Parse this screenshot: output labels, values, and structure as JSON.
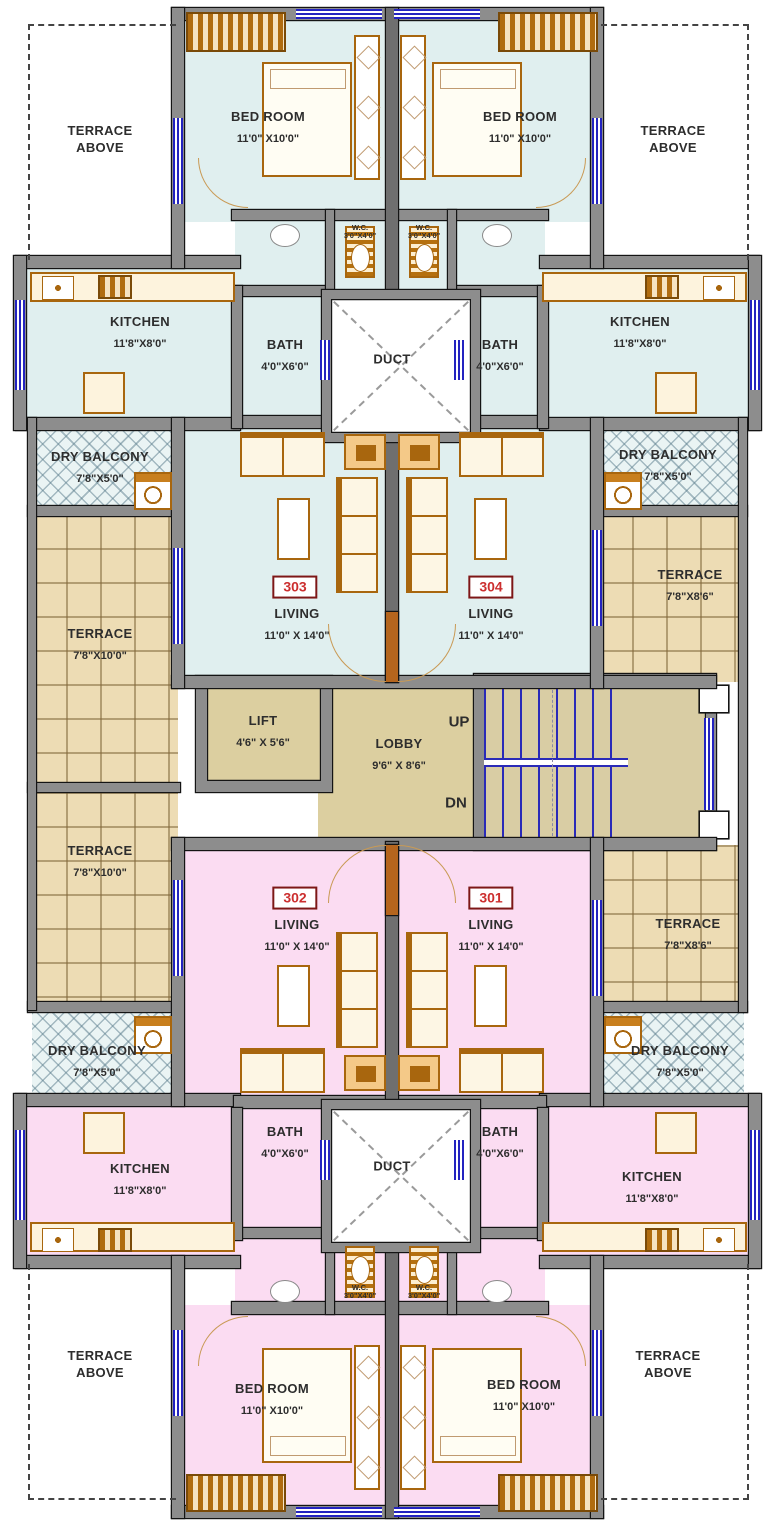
{
  "plan_title": "Typical residential floor plan",
  "colors": {
    "flat_upper_fill": "#e0efef",
    "flat_lower_fill": "#fbdcf2",
    "terrace_fill": "#eddcb4",
    "lobby_fill": "#dccfa0",
    "wall_gray": "#8d8d8d",
    "window_blue": "#2323c0",
    "furniture_orange": "#a8660e",
    "unit_number_red": "#cc2f2f"
  },
  "units": [
    {
      "number": "303",
      "room": "LIVING",
      "dim": "11'0\" X 14'0\""
    },
    {
      "number": "304",
      "room": "LIVING",
      "dim": "11'0\" X 14'0\""
    },
    {
      "number": "302",
      "room": "LIVING",
      "dim": "11'0\" X 14'0\""
    },
    {
      "number": "301",
      "room": "LIVING",
      "dim": "11'0\" X 14'0\""
    }
  ],
  "labels": {
    "terrace_above": {
      "l1": "TERRACE",
      "l2": "ABOVE"
    },
    "bedroom": {
      "name": "BED ROOM",
      "dim": "11'0\" X10'0\""
    },
    "kitchen": {
      "name": "KITCHEN",
      "dim": "11'8\"X8'0\""
    },
    "bath": {
      "name": "BATH",
      "dim": "4'0\"X6'0\""
    },
    "wc": {
      "name": "W.C.",
      "dim": "3'0\"X4'0\""
    },
    "dry_balcony": {
      "name": "DRY BALCONY",
      "dim": "7'8\"X5'0\""
    },
    "terrace_large": {
      "name": "TERRACE",
      "dim": "7'8\"X10'0\""
    },
    "terrace_small": {
      "name": "TERRACE",
      "dim": "7'8\"X8'6\""
    },
    "duct": "DUCT",
    "lift": {
      "name": "LIFT",
      "dim": "4'6\" X 5'6\""
    },
    "lobby": {
      "name": "LOBBY",
      "dim": "9'6\" X 8'6\""
    },
    "stairs": {
      "up": "UP",
      "down": "DN"
    }
  }
}
